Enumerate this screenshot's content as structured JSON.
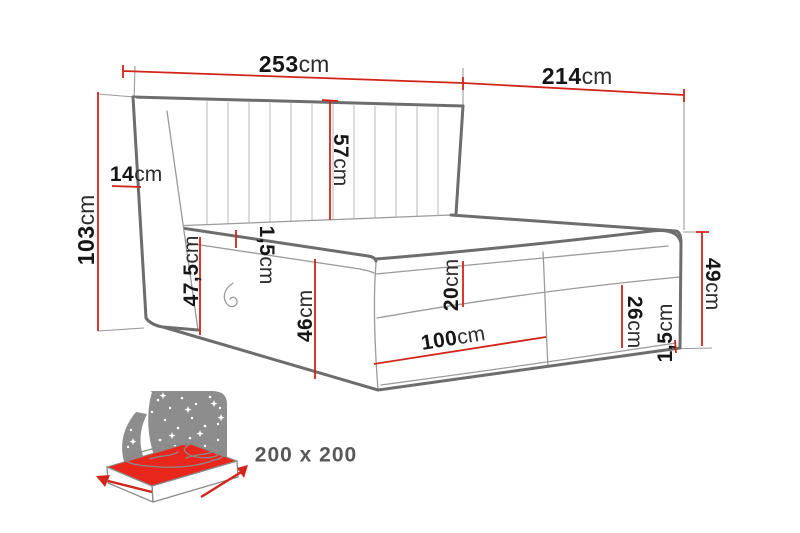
{
  "diagram": {
    "type": "bed-dimension-diagram",
    "size_label": "200 x 200",
    "dims": {
      "w253": {
        "v": "253",
        "u": "cm"
      },
      "l214": {
        "v": "214",
        "u": "cm"
      },
      "h103": {
        "v": "103",
        "u": "cm"
      },
      "wing14": {
        "v": "14",
        "u": "cm"
      },
      "hb57": {
        "v": "57",
        "u": "cm"
      },
      "top15": {
        "v": "1,5",
        "u": "cm"
      },
      "side475": {
        "v": "47,5",
        "u": "cm"
      },
      "base46": {
        "v": "46",
        "u": "cm"
      },
      "mat20": {
        "v": "20",
        "u": "cm"
      },
      "half100": {
        "v": "100",
        "u": "cm"
      },
      "base26": {
        "v": "26",
        "u": "cm"
      },
      "foot49": {
        "v": "49",
        "u": "cm"
      },
      "bot15": {
        "v": "1,5",
        "u": "cm"
      }
    },
    "colors": {
      "dimension_red": "#d22419",
      "outline_gray": "#6d6d6d",
      "seam_gray": "#9a9a9a",
      "label_dark": "#161616",
      "badge_gray": "#57585a",
      "icon_panel_gray": "#8d8d8d",
      "icon_mattress_red": "#e8261b"
    }
  }
}
